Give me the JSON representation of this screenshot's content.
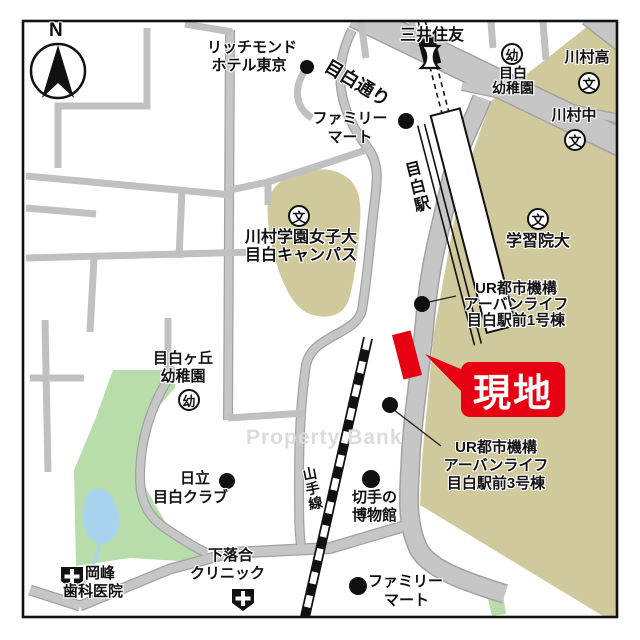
{
  "map": {
    "compass_n": "N",
    "watermark": "Property Bank",
    "site_callout": "現地",
    "station_name": "目白駅",
    "rail_line": "山手線",
    "road_name": "目白通り",
    "marks": {
      "school": "文",
      "kindergarten": "幼"
    },
    "colors": {
      "site_red": "#e60012",
      "campus_tan": "#cfc99b",
      "park_green": "#b9dcab",
      "pond_blue": "#a9d4ef",
      "road_gray": "#c6c6c6"
    },
    "pois": {
      "richmond1": "リッチモンド",
      "richmond2": "ホテル東京",
      "mitsui": "三井住友",
      "family1": "ファミリー",
      "family2": "マート",
      "mejiro_yochien1": "目白",
      "mejiro_yochien2": "幼稚園",
      "kawamura_ko": "川村高",
      "kawamura_chu": "川村中",
      "campus1": "川村学園女子大",
      "campus2": "目白キャンパス",
      "gakushuin": "学習院大",
      "ur_line1": "UR都市機構",
      "ur_line2": "アーバンライフ",
      "ur1_line3": "目白駅前1号棟",
      "ur3_line3": "目白駅前3号棟",
      "stamp1": "切手の",
      "stamp2": "博物館",
      "hitachi1": "日立",
      "hitachi2": "目白クラブ",
      "mejirogaoka1": "目白ヶ丘",
      "mejirogaoka2": "幼稚園",
      "okamine1": "岡峰",
      "okamine2": "歯科医院",
      "shimo1": "下落合",
      "shimo2": "クリニック"
    }
  }
}
